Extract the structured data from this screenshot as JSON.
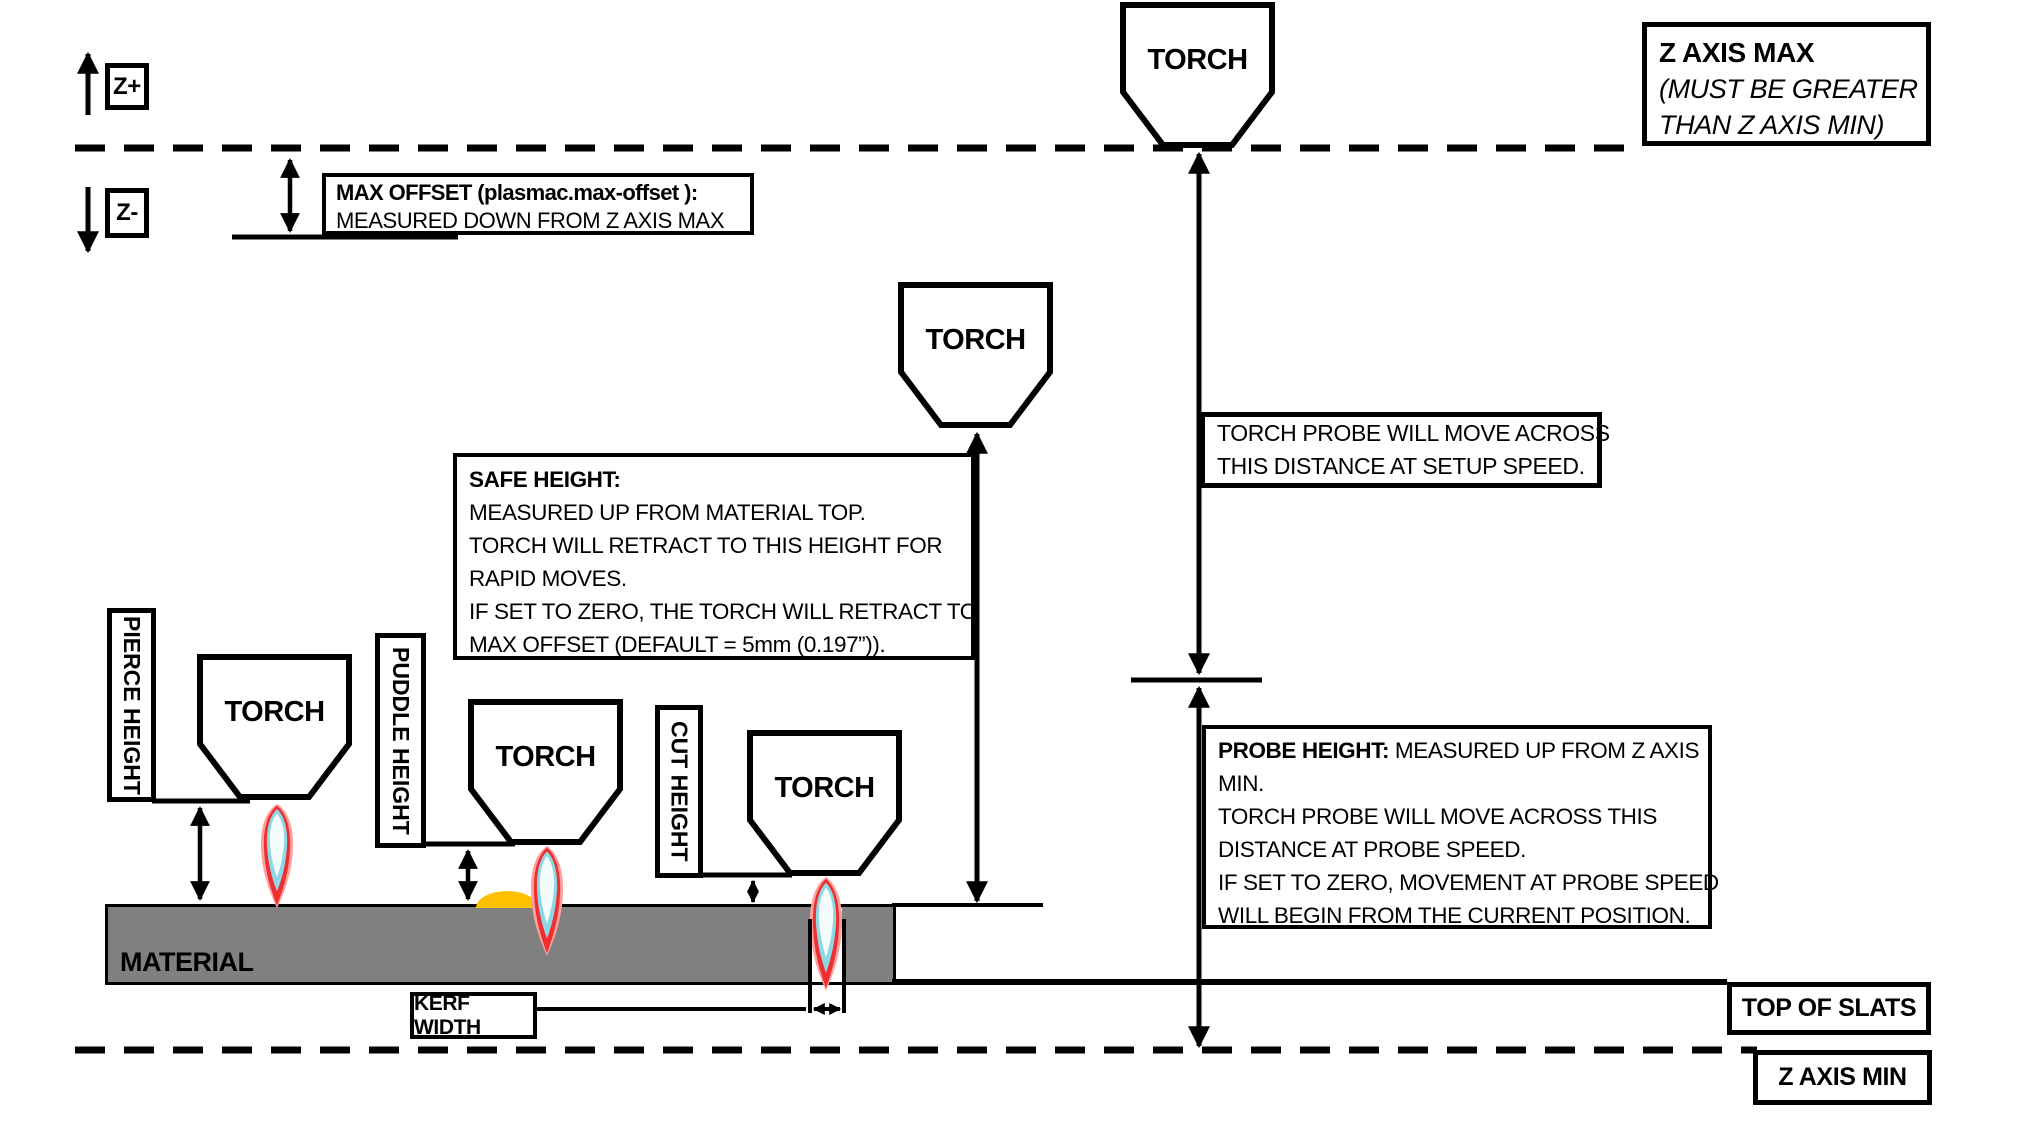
{
  "colors": {
    "line": "#000000",
    "material_fill": "#808080",
    "puddle_fill": "#FFC000",
    "flame_glow": "#FF9F9F",
    "flame_red": "#EE2F2F",
    "flame_teal": "#8ED8E6",
    "flame_core": "#F4FCFE"
  },
  "axis_indicator": {
    "z_plus_label": "Z+",
    "z_minus_label": "Z-"
  },
  "torch_label": "TORCH",
  "labels": {
    "material": "MATERIAL",
    "pierce_height": "PIERCE HEIGHT",
    "puddle_height": "PUDDLE HEIGHT",
    "cut_height": "CUT HEIGHT",
    "kerf_width": "KERF WIDTH",
    "top_of_slats": "TOP OF SLATS",
    "z_axis_min": "Z AXIS MIN"
  },
  "callouts": {
    "z_axis_max": {
      "title": "Z AXIS MAX",
      "lines": [
        "(MUST BE GREATER",
        "THAN Z AXIS MIN)"
      ]
    },
    "max_offset": {
      "title": "MAX OFFSET (plasmac.max-offset ):",
      "lines": [
        "MEASURED DOWN FROM Z AXIS MAX"
      ]
    },
    "safe_height": {
      "title": "SAFE HEIGHT:",
      "lines": [
        "MEASURED UP FROM MATERIAL TOP.",
        "TORCH WILL RETRACT TO THIS HEIGHT FOR",
        "RAPID MOVES.",
        "IF SET TO ZERO, THE TORCH WILL RETRACT TO",
        "MAX OFFSET (DEFAULT = 5mm (0.197”))."
      ]
    },
    "torch_probe": {
      "lines": [
        "TORCH PROBE WILL MOVE ACROSS",
        "THIS DISTANCE AT SETUP SPEED."
      ]
    },
    "probe_height": {
      "title": "PROBE HEIGHT:",
      "title_suffix": " MEASURED UP FROM Z AXIS",
      "lines": [
        "MIN.",
        "TORCH PROBE WILL MOVE ACROSS THIS",
        "DISTANCE AT PROBE SPEED.",
        "IF SET TO ZERO,  MOVEMENT AT PROBE SPEED",
        "WILL BEGIN FROM THE CURRENT POSITION."
      ]
    }
  }
}
